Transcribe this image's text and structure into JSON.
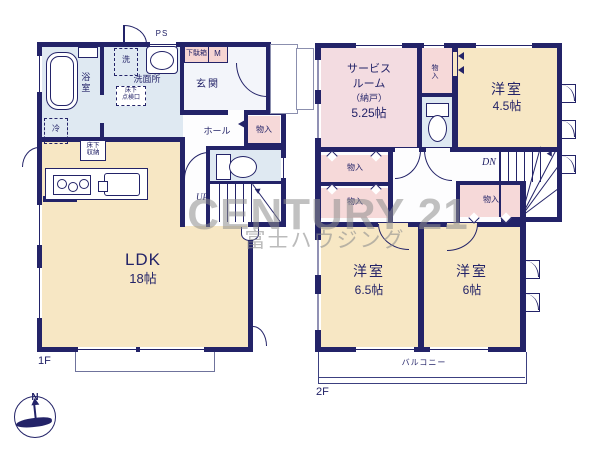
{
  "watermark": {
    "brand": "CENTURY 21",
    "company": "富士ハウジング"
  },
  "compass": {
    "north_label": "N"
  },
  "floor1": {
    "floor_label": "1F",
    "bath": "浴室",
    "washroom": "洗面所",
    "washer": "洗",
    "underfloor_hatch_line1": "床下",
    "underfloor_hatch_line2": "点検口",
    "pipe_space": "PS",
    "shoe_box": "下駄箱",
    "meter_box": "M",
    "entrance": "玄関",
    "hall": "ホール",
    "storage": "物入",
    "fridge": "冷",
    "underfloor_storage_line1": "床下",
    "underfloor_storage_line2": "収納",
    "ldk_name": "LDK",
    "ldk_size": "18帖",
    "stairs_up": "UP"
  },
  "floor2": {
    "floor_label": "2F",
    "service_room_line1": "サービス",
    "service_room_line2": "ルーム",
    "service_room_line3": "（納戸）",
    "service_room_size": "5.25帖",
    "storage_top": "物入",
    "western_room_a_name": "洋室",
    "western_room_a_size": "4.5帖",
    "storage_left_upper": "物入",
    "storage_left_lower": "物入",
    "storage_center": "物入",
    "stairs_down": "DN",
    "western_room_b_name": "洋室",
    "western_room_b_size": "6.5帖",
    "western_room_c_name": "洋室",
    "western_room_c_size": "6帖",
    "balcony": "バルコニー"
  },
  "colors": {
    "wall": "#232368",
    "room_cream": "#f7e7c4",
    "room_pink": "#f4dadd",
    "room_blue": "#dfe9f2",
    "watermark_gray": "#8f8f8f"
  }
}
